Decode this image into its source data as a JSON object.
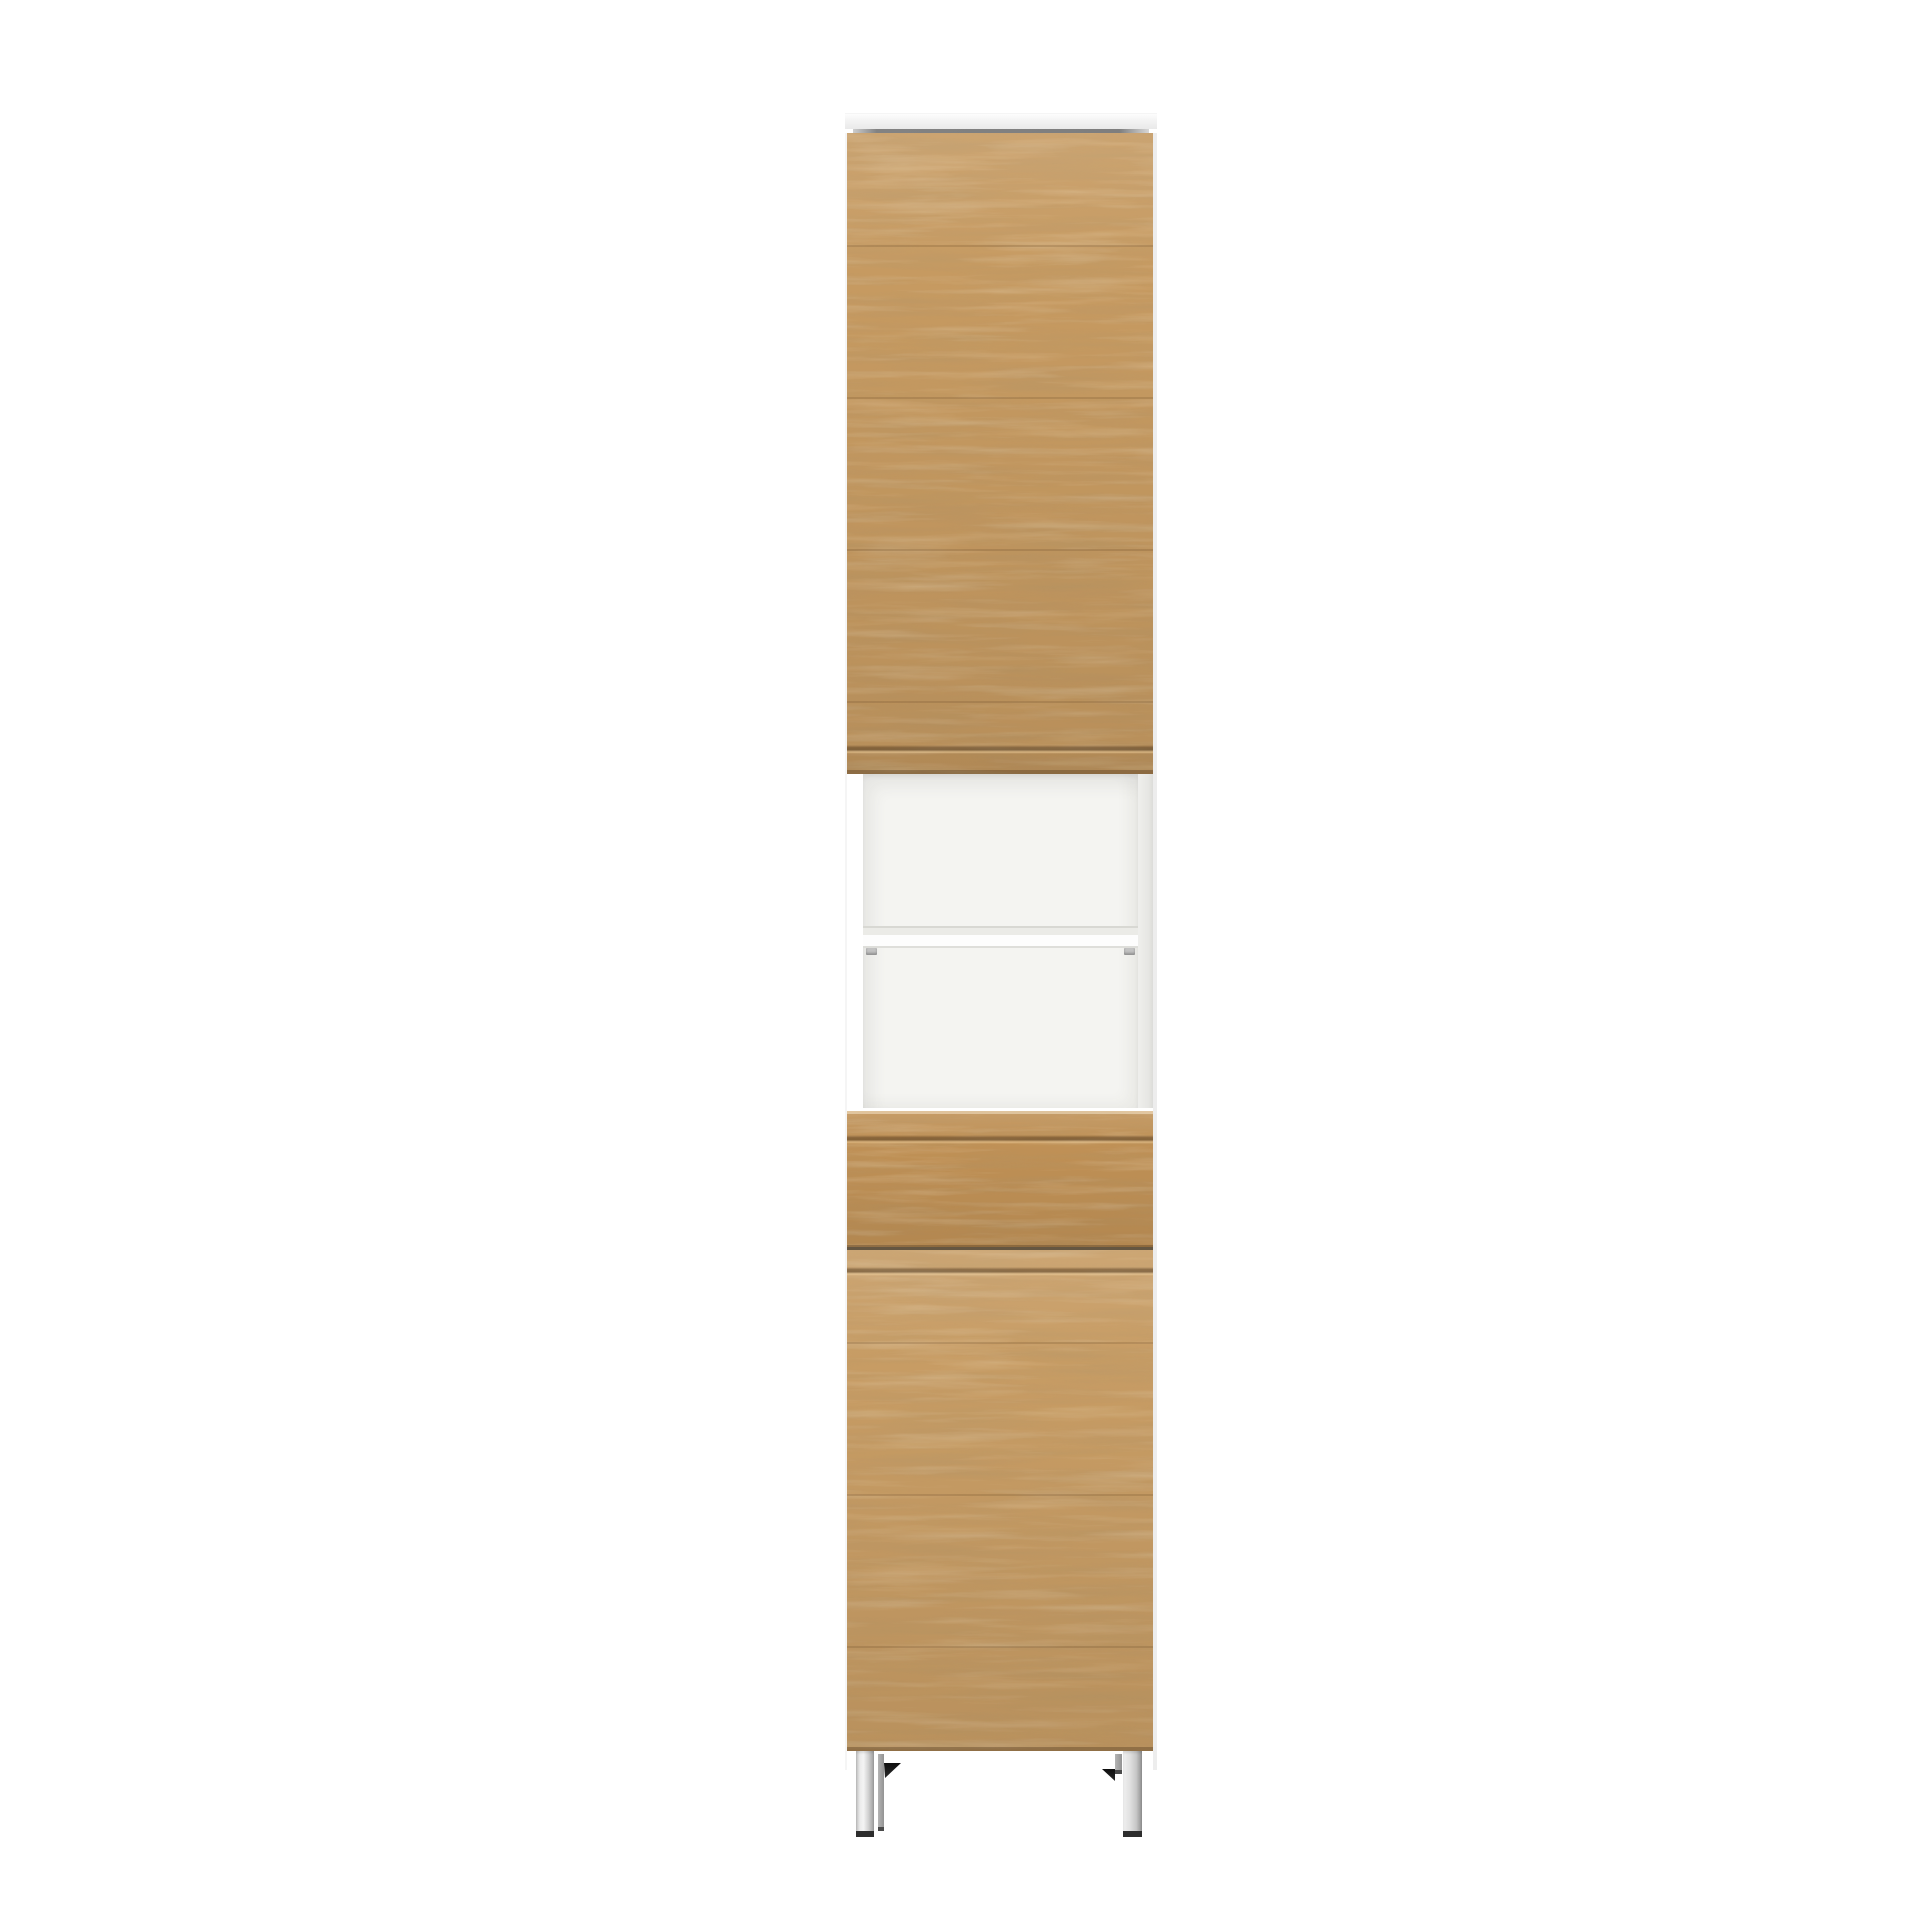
{
  "scene": {
    "subject": "Tall narrow bathroom tallboy cabinet with oak-effect fronts, white carcass, open shelf niche and chrome feet, photographed on a plain white background",
    "background_color": "#ffffff"
  },
  "colors": {
    "background": "#ffffff",
    "wood_upper_door": "#c69a61",
    "wood_drawer": "#c09156",
    "wood_lower_door": "#c79c64",
    "grain_dark": "#6e4e28",
    "top_panel": "#f4f4f4",
    "top_shadow_line": "#7f7f7f",
    "carcass_side_left": "#f5f5f5",
    "carcass_side_right": "#ededed",
    "niche_interior": "#f4f4f1",
    "niche_right_wall": "#e8e8e5",
    "shelf_front": "#fdfdfd",
    "shelf_pin": "#c2c2c2",
    "panel_seam": "#4a3820",
    "leg_chrome_light": "#f2f2f2",
    "leg_chrome_dark": "#9c9c9c",
    "leg_back_gray": "#a5a5a5",
    "leg_foot": "#2d2d2d",
    "shadow_wedge": "#141414"
  },
  "parts": {
    "cabinet": "tall cabinet",
    "top_panel": "white top panel",
    "upper_door": "upper oak door with routed grip groove",
    "niche": "open white shelf niche",
    "shelf": "middle shelf",
    "shelf_pin": "shelf support pin",
    "drawer": "oak drawer front with grip groove",
    "lower_door": "lower oak door with grip groove",
    "leg": "square chrome foot",
    "leg_shadow": "floor shadow under cabinet"
  }
}
